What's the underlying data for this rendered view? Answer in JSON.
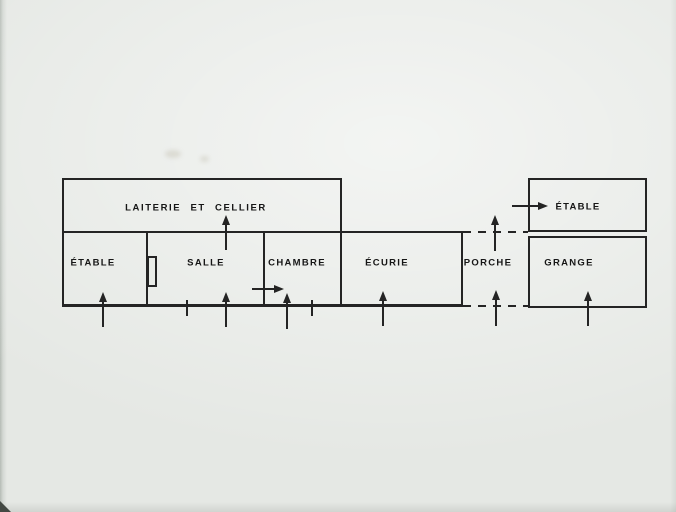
{
  "colors": {
    "background": "#e5e8e4",
    "paper": "#e9ece8",
    "line": "#242424",
    "text": "#161616"
  },
  "plan": {
    "rooms": [
      {
        "id": "laiterie-cellier",
        "label": "LAITERIE  ET  CELLIER"
      },
      {
        "id": "etable-west",
        "label": "ÉTABLE"
      },
      {
        "id": "salle",
        "label": "SALLE"
      },
      {
        "id": "chambre",
        "label": "CHAMBRE"
      },
      {
        "id": "ecurie",
        "label": "ÉCURIE"
      },
      {
        "id": "porche",
        "label": "PORCHE"
      },
      {
        "id": "grange",
        "label": "GRANGE"
      },
      {
        "id": "etable-north",
        "label": "ÉTABLE"
      }
    ],
    "icons": [
      {
        "id": "entrance-arrow",
        "meaning": "arrow marking an entrance/doorway"
      }
    ]
  }
}
